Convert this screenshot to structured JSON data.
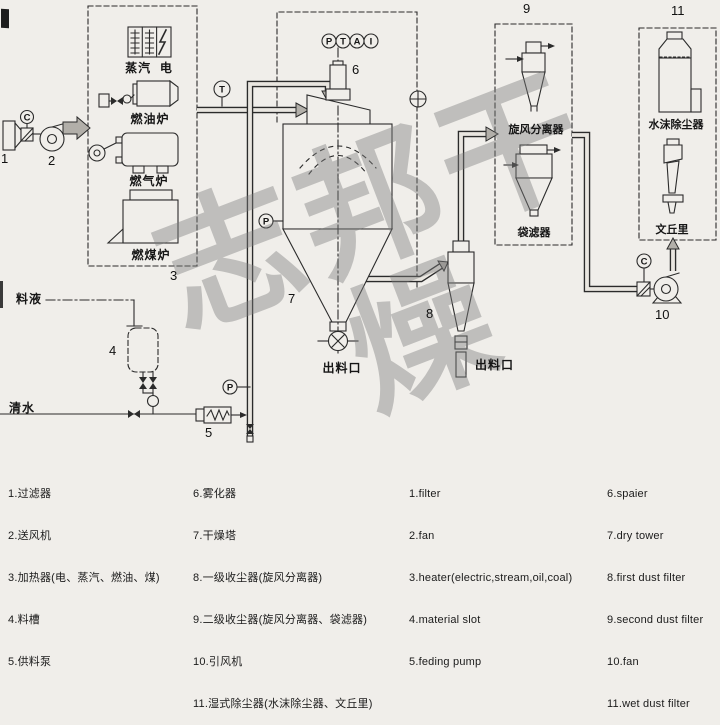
{
  "meta": {
    "background": "#f0eeea",
    "line_color": "#2b2b2b",
    "arrow_fill": "#b2afa9",
    "watermark_color": "rgba(125,125,125,0.42)"
  },
  "watermark": "志邦干燥",
  "diagram": {
    "numbers": {
      "n1": "1",
      "n2": "2",
      "n3": "3",
      "n4": "4",
      "n5": "5",
      "n6": "6",
      "n7": "7",
      "n8": "8",
      "n9": "9",
      "n10": "10",
      "n11": "11"
    },
    "instruments": {
      "c_inlet": "C",
      "t_duct": "T",
      "p_tower": "P",
      "p_feed": "P",
      "c_fan": "C",
      "head": [
        "P",
        "T",
        "A",
        "I"
      ]
    },
    "labels": {
      "steam_electric": "蒸汽  电",
      "oil_furnace": "燃油炉",
      "gas_furnace": "燃气炉",
      "coal_furnace": "燃煤炉",
      "feed_liquid": "料液",
      "clean_water": "清水",
      "tower_discharge": "出料口",
      "cyclone_discharge": "出料口",
      "cyclone_separator": "旋风分离器",
      "bag_filter": "袋滤器",
      "water_mist_collector": "水沫除尘器",
      "venturi": "文丘里"
    }
  },
  "legend": {
    "zh_col1": [
      "1.过滤器",
      "2.送风机",
      "3.加热器(电、蒸汽、燃油、煤)",
      "4.料槽",
      "5.供料泵"
    ],
    "zh_col2": [
      "6.雾化器",
      "7.干燥塔",
      "8.一级收尘器(旋风分离器)",
      "9.二级收尘器(旋风分离器、袋滤器)",
      "10.引风机",
      "11.湿式除尘器(水沫除尘器、文丘里)"
    ],
    "en_col1": [
      "1.filter",
      "2.fan",
      "3.heater(electric,stream,oil,coal)",
      "4.material slot",
      "5.feding pump"
    ],
    "en_col2": [
      "6.spaier",
      "7.dry tower",
      "8.first dust filter",
      "9.second dust filter",
      "10.fan",
      "11.wet dust filter"
    ]
  }
}
